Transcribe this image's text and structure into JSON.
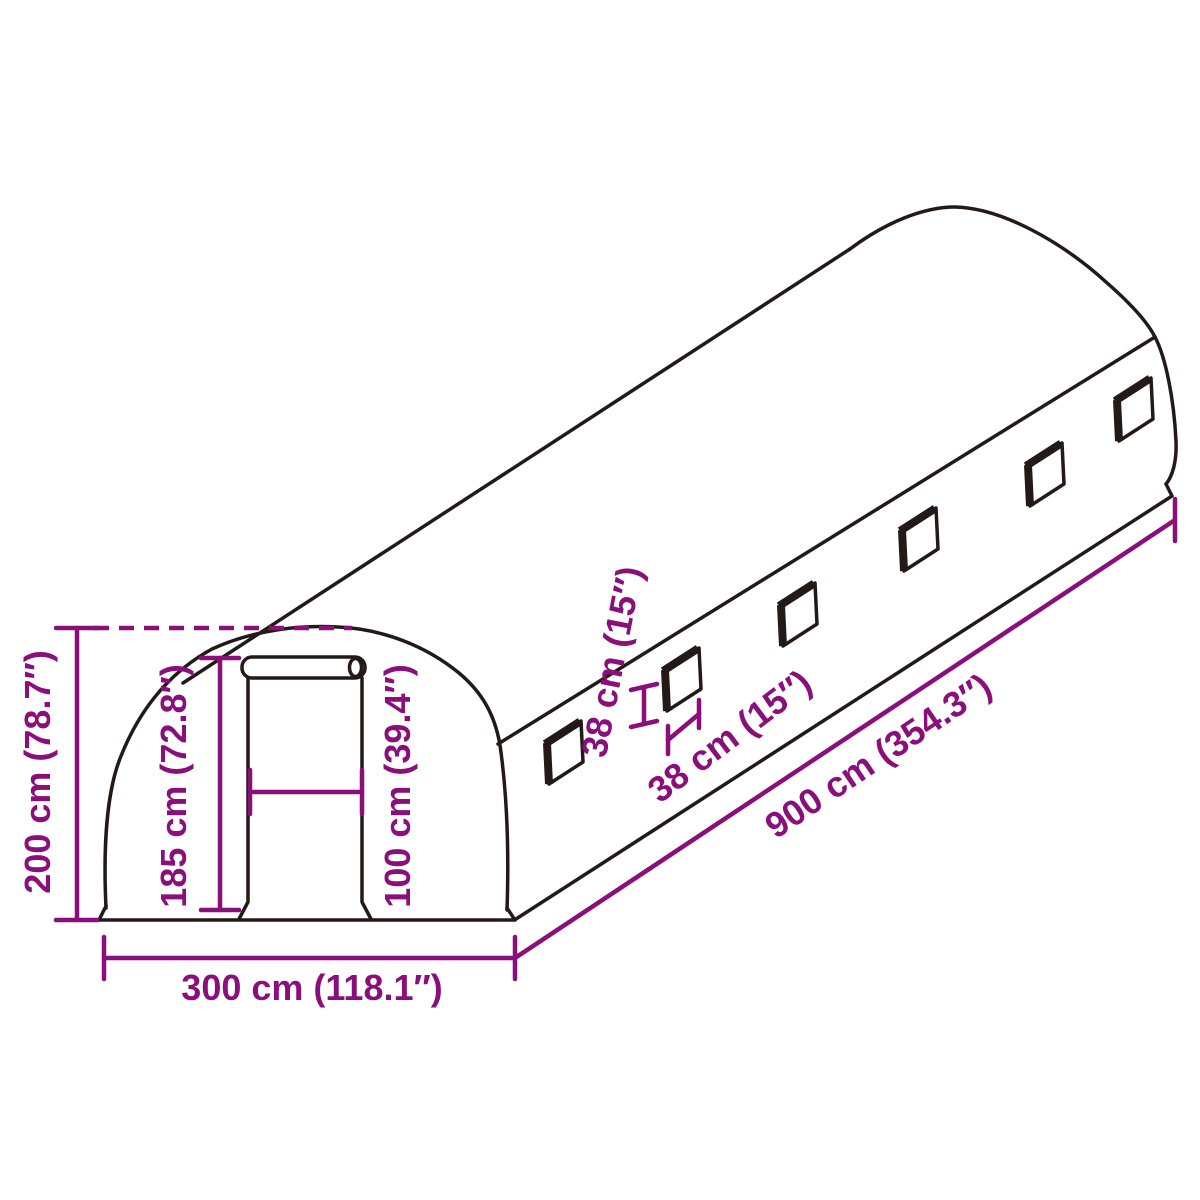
{
  "diagram": {
    "title": "greenhouse-tunnel-dimension-drawing",
    "colors": {
      "background": "#ffffff",
      "line": "#231a17",
      "dimension": "#8b0f7b"
    },
    "structure": {
      "window_count": 6,
      "parts": [
        "front-arch",
        "roll-up-door",
        "side-wall",
        "rear-arch",
        "side-windows"
      ]
    },
    "dimensions": {
      "total_height": "200 cm (78.7″)",
      "door_height": "185 cm (72.8″)",
      "door_width": "100 cm (39.4″)",
      "total_width": "300 cm (118.1″)",
      "total_length": "900 cm (354.3″)",
      "window_height": "38 cm (15″)",
      "window_width": "38 cm (15″)"
    }
  }
}
